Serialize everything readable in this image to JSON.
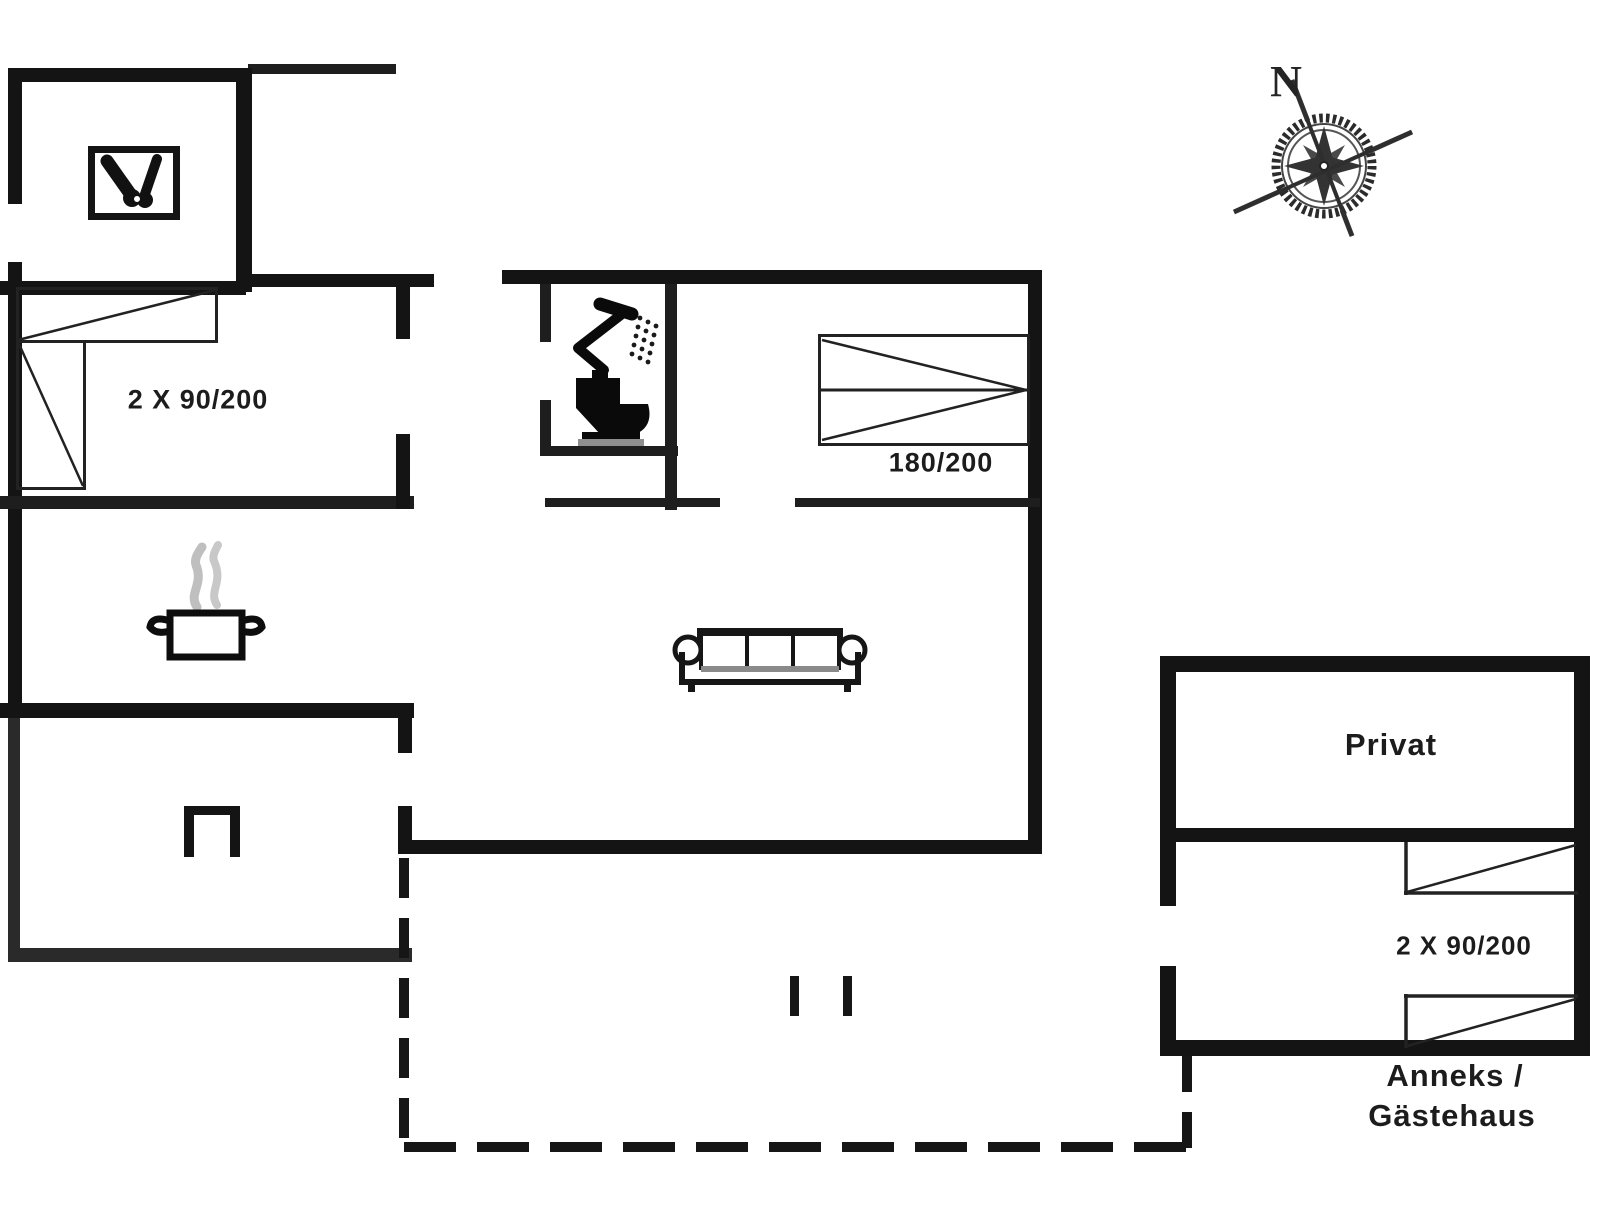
{
  "colors": {
    "ink": "#141414",
    "steam": "#bfbfbf",
    "label": "#1c1c1c",
    "background": "#ffffff"
  },
  "plan": {
    "main_house": {
      "bedroom1": {
        "bed_label": "2 X 90/200",
        "beds": [
          "single-bed-horizontal",
          "single-bed-vertical"
        ]
      },
      "bedroom2": {
        "bed_label": "180/200",
        "beds": [
          "double-bed"
        ]
      },
      "bathroom": {
        "fixtures": [
          "shower-icon",
          "toilet-icon"
        ]
      },
      "kitchen": {
        "fixtures": [
          "cooking-pot-icon"
        ]
      },
      "living_room": {
        "fixtures": [
          "sofa-icon"
        ]
      },
      "utility_room": {
        "fixtures": [
          "utility-tools-icon"
        ]
      },
      "hearth_room": {
        "fixtures": [
          "fireplace-icon"
        ]
      }
    },
    "annex": {
      "room_label": "Privat",
      "bed_label": "2 X 90/200",
      "caption_line1": "Anneks /",
      "caption_line2": "Gästehaus",
      "beds": [
        "single-bed",
        "single-bed"
      ]
    },
    "compass": {
      "north_label": "N"
    },
    "terrace": {
      "boundary_style": "dashed"
    }
  }
}
